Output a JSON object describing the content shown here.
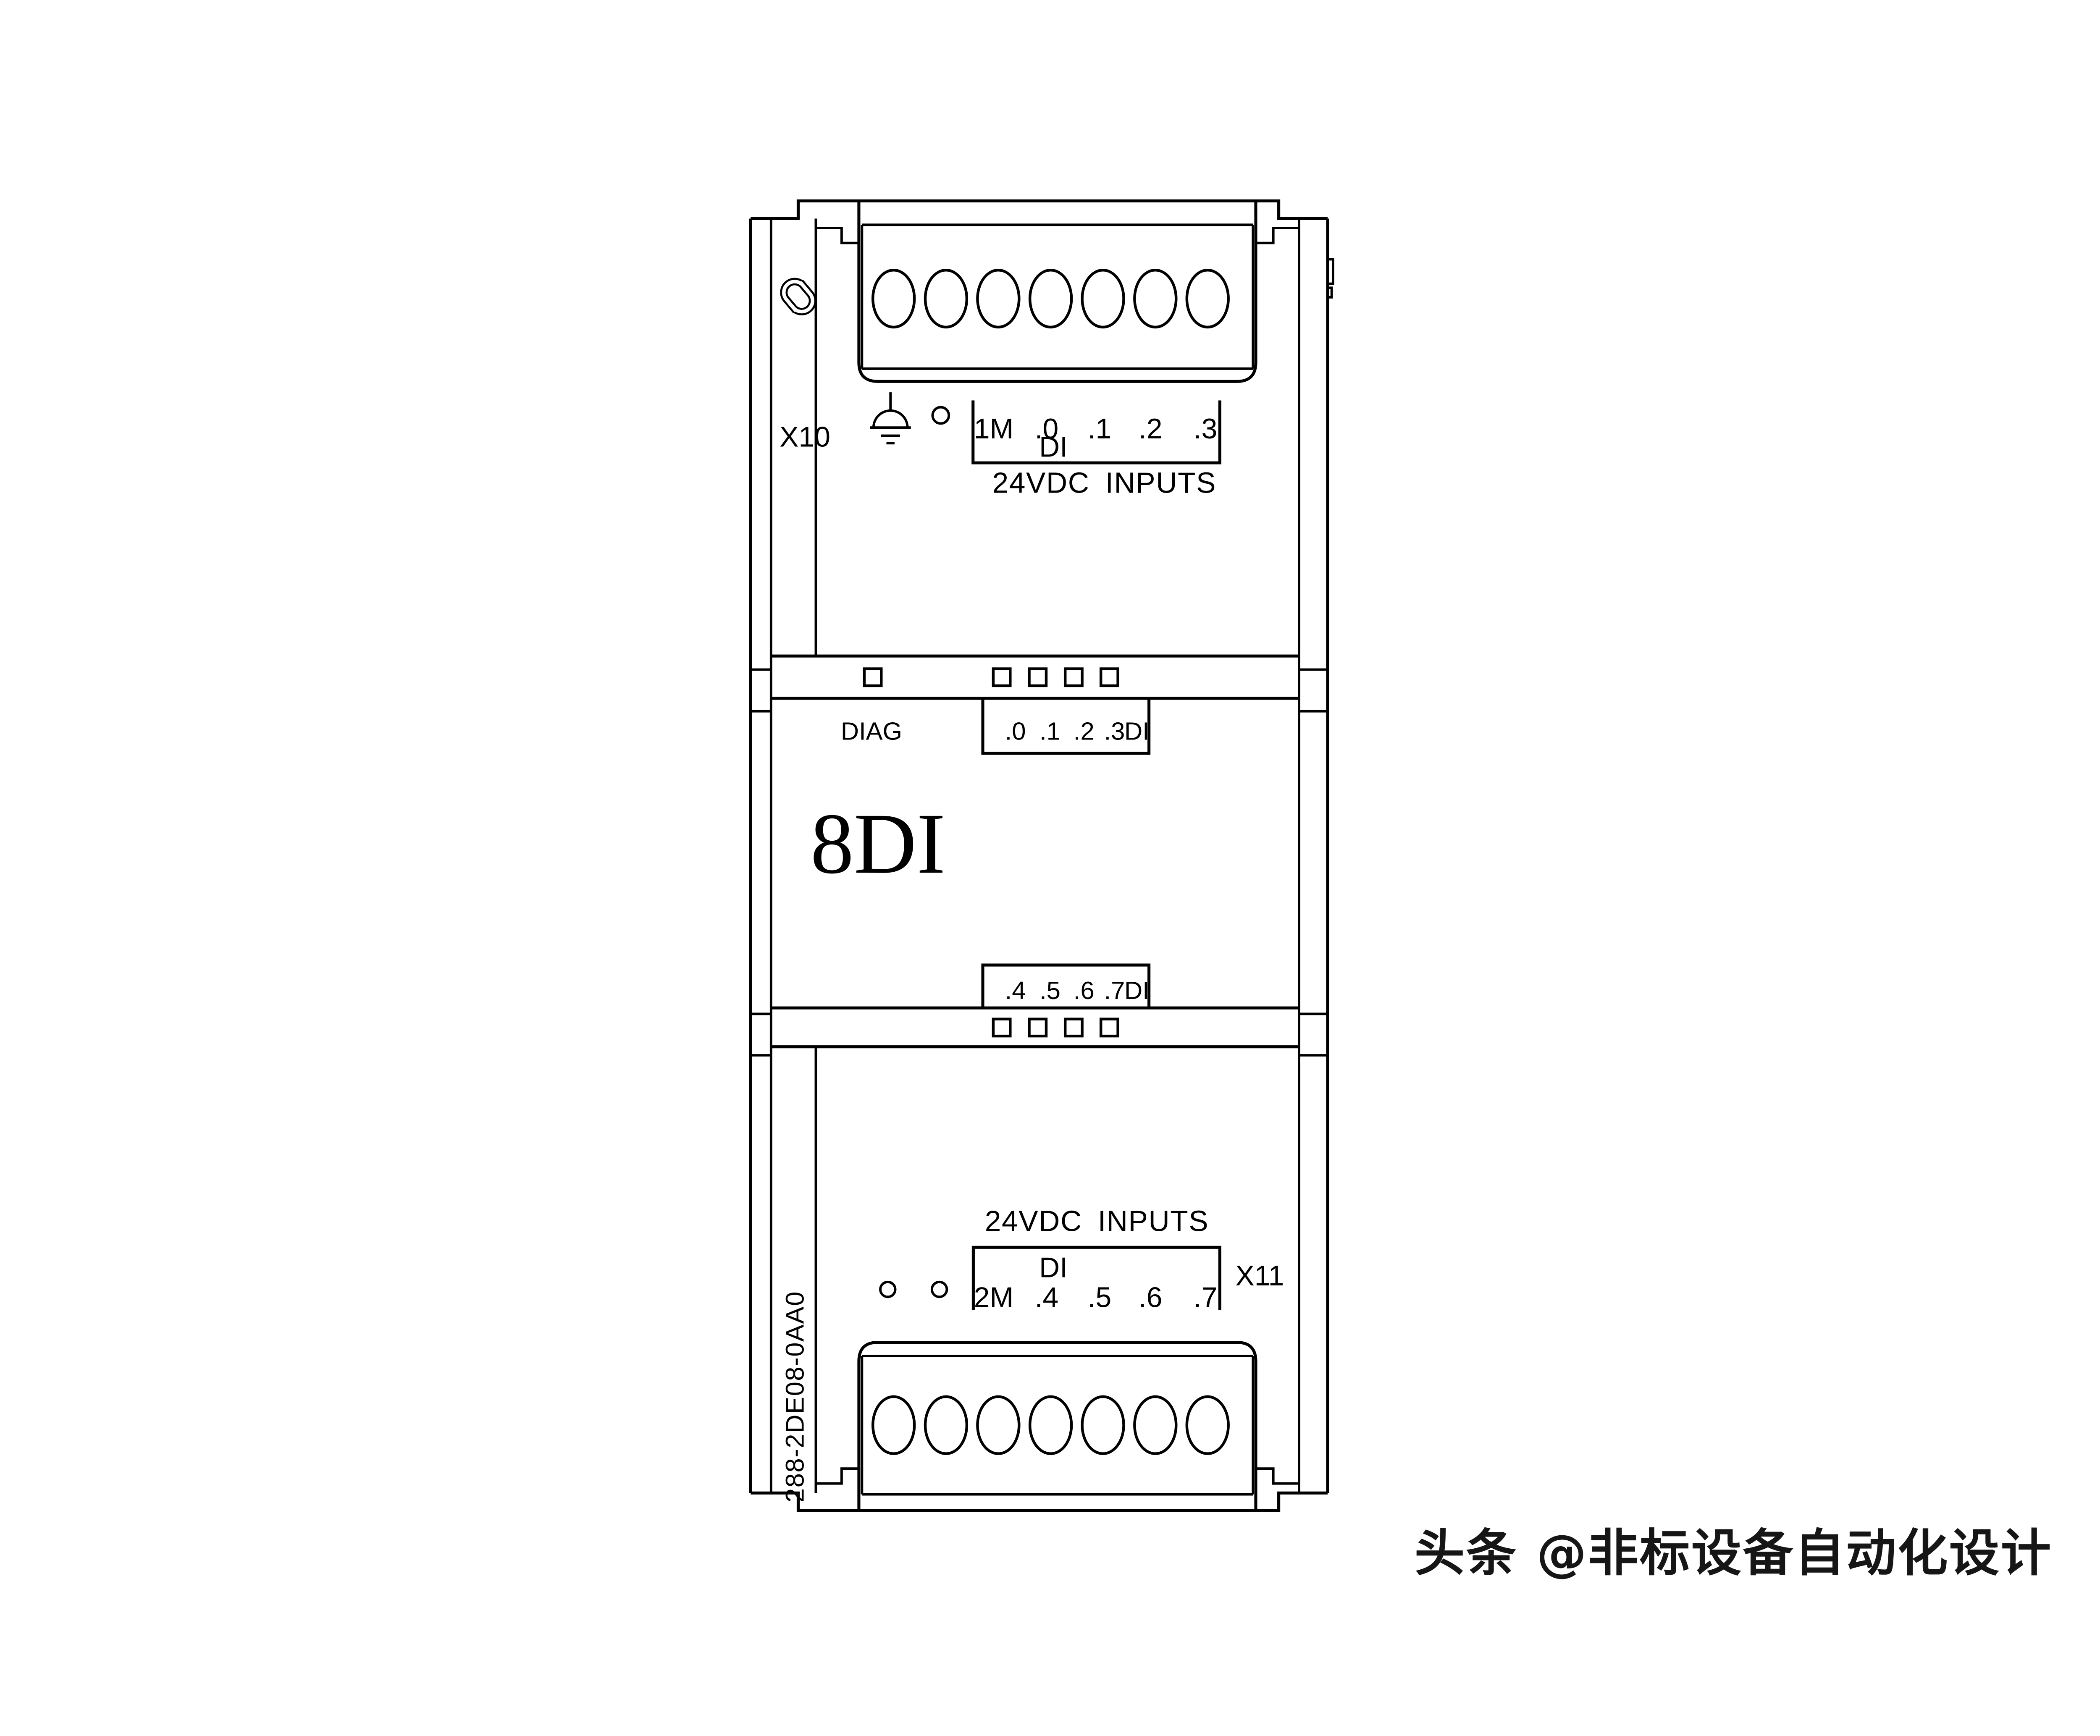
{
  "module": {
    "size_label": "8DI",
    "order_number": "288-2DE08-0AA0"
  },
  "connectors": {
    "top": {
      "id": "X10",
      "terminals": [
        "1M",
        ".0",
        ".1",
        ".2",
        ".3"
      ],
      "group": "DI",
      "caption": "24VDC INPUTS"
    },
    "bottom": {
      "id": "X11",
      "terminals": [
        "2M",
        ".4",
        ".5",
        ".6",
        ".7"
      ],
      "group": "DI",
      "caption": "24VDC INPUTS"
    }
  },
  "leds": {
    "diag": "DIAG",
    "upper": {
      "channels": [
        ".0",
        ".1",
        ".2",
        ".3"
      ],
      "group": "DI"
    },
    "lower": {
      "channels": [
        ".4",
        ".5",
        ".6",
        ".7"
      ],
      "group": "DI"
    }
  },
  "watermark": {
    "text": "头条 @非标设备自动化设计",
    "color": "#161616"
  },
  "colors": {
    "line": "#000000",
    "background": "#ffffff"
  }
}
